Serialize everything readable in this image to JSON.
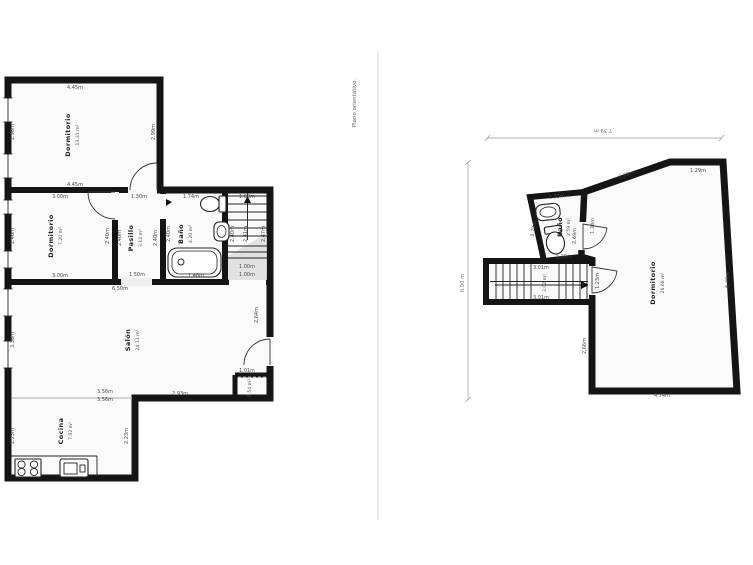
{
  "caption": "Plano orientativo.",
  "lp": {
    "d1": {
      "name": "Dormitorio",
      "area": "13.31 m²",
      "top": "4.45m",
      "bottom": "4.45m",
      "left": "2.96m",
      "right": "2.99m"
    },
    "d2": {
      "name": "Dormitorio",
      "area": "7.20 m²",
      "top": "3.00m",
      "bottom": "3.00m",
      "left": "2.40m",
      "right": "2.40m"
    },
    "pa": {
      "name": "Pasillo",
      "area": "3.12 m²",
      "top": "1.30m",
      "bottom": "1.50m",
      "left": "2.40m",
      "right": "2.40m"
    },
    "ba": {
      "name": "Baño",
      "area": "4.20 m²",
      "top": "1.74m",
      "left": "2.40m",
      "bottom": "1.40m"
    },
    "st": {
      "top": "1.00m",
      "v1": "2.40m",
      "v2": "2.41m",
      "v3": "2.47m",
      "b1": "1.00m",
      "b2": "1.00m"
    },
    "sa": {
      "name": "Salón",
      "area": "24.11 m²",
      "top": "6.50m",
      "left": "3.36m",
      "right": "2.64m",
      "bottom": "2.93m",
      "closet_w": "1.01m",
      "closet_area": "0.54 m²",
      "w1": "3.56m",
      "w2": "3.56m"
    },
    "co": {
      "name": "Cocina",
      "area": "7.92 m²",
      "left": "2.23m",
      "right": "2.23m"
    }
  },
  "rp": {
    "width": "7.39 m",
    "height": "6.90 m",
    "ba": {
      "name": "Baño",
      "area": "2.59 m²",
      "top": "1.33m",
      "left": "1.79m",
      "bottom": "1.36m"
    },
    "do": {
      "name": "Dormitorio",
      "area": "26.68 m²",
      "slant": "2.68m",
      "topright": "1.29m",
      "right": "6.49m",
      "bottom": "4.74m",
      "left": "2.66m",
      "door1": "2.69m",
      "door1b": "1.34m",
      "door2": "1.23m"
    },
    "st": {
      "top": "3.01m",
      "area": "3.02 m²",
      "bottom": "3.01m"
    }
  },
  "colors": {
    "wall": "#151515",
    "room_fill": "#fafafa",
    "dim_text": "#4a4a4a",
    "divider": "#d9d9d9",
    "shade": "#dcdcdc"
  }
}
